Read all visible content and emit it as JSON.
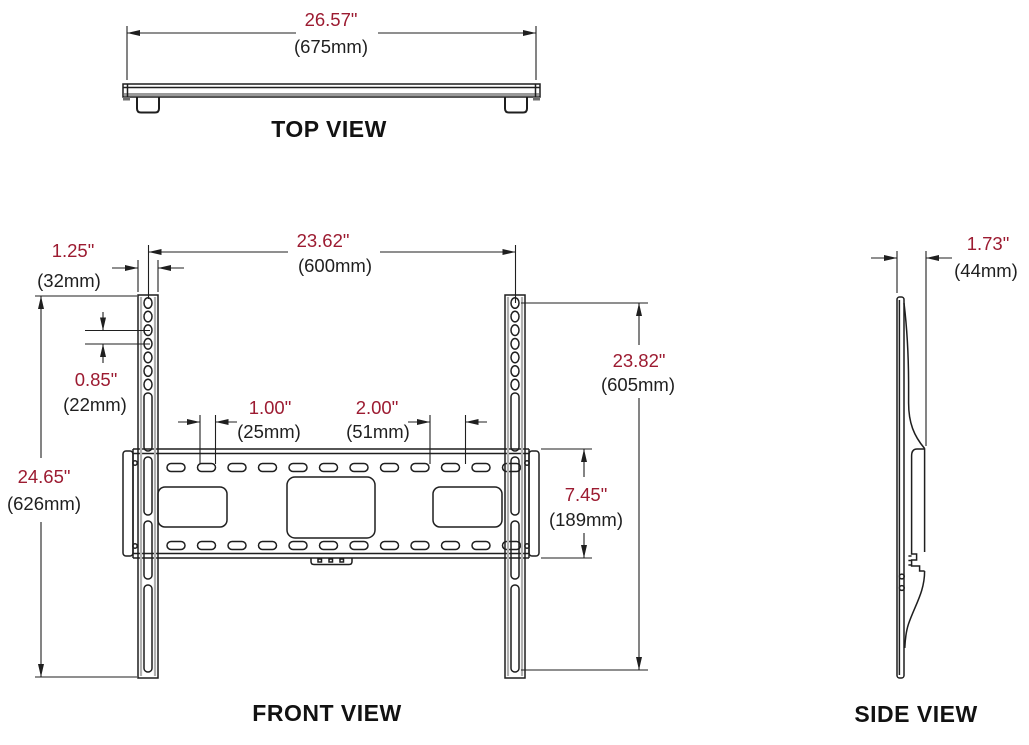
{
  "drawing": {
    "title": "wall-mount-dimension-drawing",
    "background": "#ffffff",
    "ink_color": "#1f1f1f",
    "accent_inch_color": "#9c1b31",
    "views": {
      "top": {
        "label": "TOP VIEW"
      },
      "front": {
        "label": "FRONT VIEW"
      },
      "side": {
        "label": "SIDE VIEW"
      }
    },
    "dims": {
      "overall_width": {
        "in": "26.57\"",
        "mm": "(675mm)"
      },
      "mount_hole_span": {
        "in": "23.62\"",
        "mm": "(600mm)"
      },
      "rail_width": {
        "in": "1.25\"",
        "mm": "(32mm)"
      },
      "hole_spacing": {
        "in": "0.85\"",
        "mm": "(22mm)"
      },
      "slot_length": {
        "in": "1.00\"",
        "mm": "(25mm)"
      },
      "slot_spacing": {
        "in": "2.00\"",
        "mm": "(51mm)"
      },
      "overall_height": {
        "in": "24.65\"",
        "mm": "(626mm)"
      },
      "mount_hole_height": {
        "in": "23.82\"",
        "mm": "(605mm)"
      },
      "plate_height": {
        "in": "7.45\"",
        "mm": "(189mm)"
      },
      "depth": {
        "in": "1.73\"",
        "mm": "(44mm)"
      }
    }
  }
}
